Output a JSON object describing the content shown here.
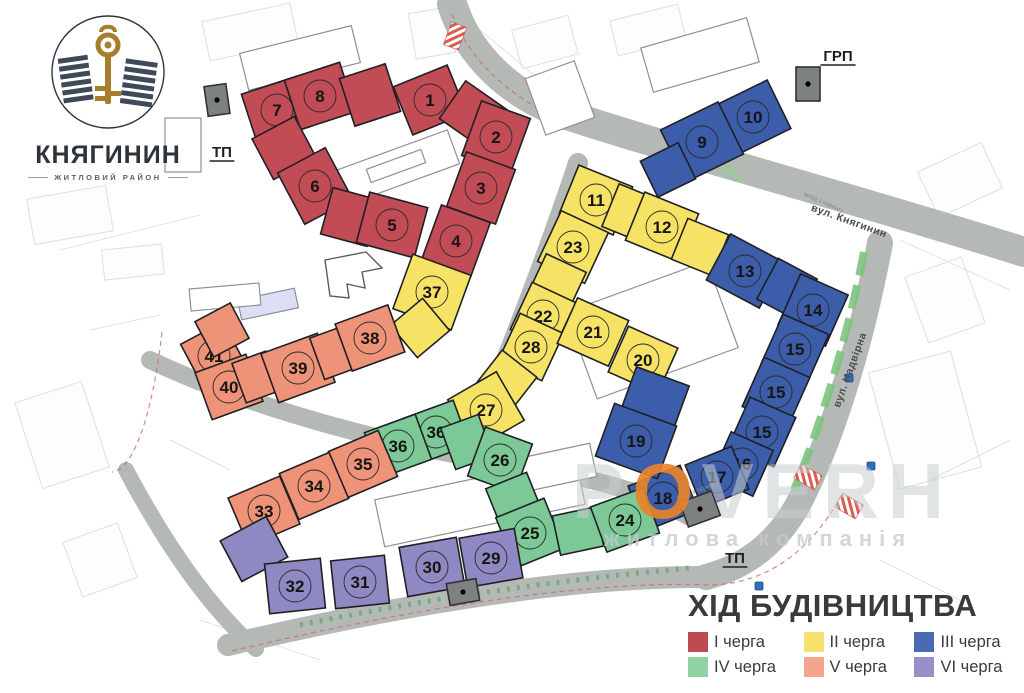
{
  "logo": {
    "name": "КНЯГИНИН",
    "subtitle": "ЖИТЛОВИЙ РАЙОН"
  },
  "watermark": {
    "text": "POVERH",
    "accent_index": 1,
    "subtext": "житлова компанія"
  },
  "footer": {
    "title": "ХІД БУДІВНИЦТВА"
  },
  "legend": {
    "items": [
      {
        "label": "I черга",
        "color": "#BE4A54"
      },
      {
        "label": "II черга",
        "color": "#F6E26B"
      },
      {
        "label": "III черга",
        "color": "#4A6BB2"
      },
      {
        "label": "IV черга",
        "color": "#90D2A3"
      },
      {
        "label": "V черга",
        "color": "#F4A58D"
      },
      {
        "label": "VI черга",
        "color": "#9790C8"
      }
    ]
  },
  "map": {
    "phase_colors": {
      "1": "#C14C55",
      "2": "#F6E366",
      "3": "#3C5DA9",
      "4": "#7CC897",
      "5": "#EE9377",
      "6": "#8F89C3"
    },
    "units": [
      {
        "n": "7",
        "phase": 1,
        "x": 277,
        "y": 110,
        "r": -18
      },
      {
        "n": "8",
        "phase": 1,
        "x": 320,
        "y": 96,
        "r": -18
      },
      {
        "n": "",
        "phase": 1,
        "x": 370,
        "y": 95,
        "r": -18,
        "w": 48,
        "h": 50
      },
      {
        "n": "1",
        "phase": 1,
        "x": 430,
        "y": 100,
        "r": -22
      },
      {
        "n": "",
        "phase": 1,
        "x": 473,
        "y": 114,
        "r": -55,
        "w": 46,
        "h": 50
      },
      {
        "n": "2",
        "phase": 1,
        "x": 496,
        "y": 137,
        "r": -70
      },
      {
        "n": "3",
        "phase": 1,
        "x": 481,
        "y": 188,
        "r": -70
      },
      {
        "n": "4",
        "phase": 1,
        "x": 456,
        "y": 241,
        "r": -70
      },
      {
        "n": "",
        "phase": 1,
        "x": 284,
        "y": 148,
        "r": 62,
        "w": 46,
        "h": 48
      },
      {
        "n": "6",
        "phase": 1,
        "x": 315,
        "y": 186,
        "r": 62,
        "w": 58,
        "h": 54
      },
      {
        "n": "",
        "phase": 1,
        "x": 350,
        "y": 217,
        "r": 15,
        "w": 48,
        "h": 48
      },
      {
        "n": "5",
        "phase": 1,
        "x": 392,
        "y": 225,
        "r": 15,
        "w": 60,
        "h": 52
      },
      {
        "n": "37",
        "phase": 2,
        "x": 432,
        "y": 292,
        "r": -70,
        "w": 58,
        "h": 62
      },
      {
        "n": "",
        "phase": 2,
        "x": 420,
        "y": 328,
        "r": -40,
        "w": 42,
        "h": 42
      },
      {
        "n": "11",
        "phase": 2,
        "x": 596,
        "y": 200,
        "r": 22
      },
      {
        "n": "",
        "phase": 2,
        "x": 630,
        "y": 213,
        "r": 22,
        "w": 42,
        "h": 46
      },
      {
        "n": "12",
        "phase": 2,
        "x": 662,
        "y": 227,
        "r": 22
      },
      {
        "n": "",
        "phase": 2,
        "x": 700,
        "y": 247,
        "r": 22,
        "w": 44,
        "h": 44
      },
      {
        "n": "23",
        "phase": 2,
        "x": 573,
        "y": 247,
        "r": -65,
        "w": 56,
        "h": 52
      },
      {
        "n": "",
        "phase": 2,
        "x": 557,
        "y": 283,
        "r": -65,
        "w": 44,
        "h": 44
      },
      {
        "n": "22",
        "phase": 2,
        "x": 543,
        "y": 316,
        "r": -65,
        "w": 52,
        "h": 48
      },
      {
        "n": "28",
        "phase": 2,
        "x": 531,
        "y": 347,
        "r": -65,
        "w": 52,
        "h": 48
      },
      {
        "n": "21",
        "phase": 2,
        "x": 593,
        "y": 332,
        "r": 24,
        "w": 56,
        "h": 50
      },
      {
        "n": "20",
        "phase": 2,
        "x": 643,
        "y": 360,
        "r": 24,
        "w": 54,
        "h": 50
      },
      {
        "n": "",
        "phase": 2,
        "x": 506,
        "y": 381,
        "r": -52,
        "w": 44,
        "h": 44
      },
      {
        "n": "27",
        "phase": 2,
        "x": 486,
        "y": 410,
        "r": -30,
        "w": 56,
        "h": 56
      },
      {
        "n": "10",
        "phase": 3,
        "x": 753,
        "y": 117,
        "r": -26,
        "w": 58,
        "h": 54
      },
      {
        "n": "9",
        "phase": 3,
        "x": 702,
        "y": 142,
        "r": -26,
        "w": 64,
        "h": 58
      },
      {
        "n": "",
        "phase": 3,
        "x": 668,
        "y": 170,
        "r": -26,
        "w": 42,
        "h": 40
      },
      {
        "n": "13",
        "phase": 3,
        "x": 745,
        "y": 271,
        "r": 28,
        "w": 60,
        "h": 52
      },
      {
        "n": "",
        "phase": 3,
        "x": 787,
        "y": 289,
        "r": 28,
        "w": 44,
        "h": 46
      },
      {
        "n": "14",
        "phase": 3,
        "x": 813,
        "y": 310,
        "r": -66,
        "w": 56,
        "h": 52
      },
      {
        "n": "15",
        "phase": 3,
        "x": 795,
        "y": 349,
        "r": -66,
        "w": 54,
        "h": 50
      },
      {
        "n": "15",
        "phase": 3,
        "x": 776,
        "y": 392,
        "r": -66,
        "w": 54,
        "h": 50
      },
      {
        "n": "15",
        "phase": 3,
        "x": 762,
        "y": 432,
        "r": -66,
        "w": 54,
        "h": 50
      },
      {
        "n": "16",
        "phase": 3,
        "x": 742,
        "y": 464,
        "r": -66,
        "w": 50,
        "h": 46
      },
      {
        "n": "17",
        "phase": 3,
        "x": 717,
        "y": 477,
        "r": -22,
        "w": 50,
        "h": 46
      },
      {
        "n": "18",
        "phase": 3,
        "x": 663,
        "y": 498,
        "r": -22,
        "w": 56,
        "h": 48
      },
      {
        "n": "",
        "phase": 3,
        "x": 655,
        "y": 398,
        "r": -70,
        "w": 46,
        "h": 56
      },
      {
        "n": "19",
        "phase": 3,
        "x": 636,
        "y": 441,
        "r": -70,
        "w": 56,
        "h": 66
      },
      {
        "n": "36",
        "phase": 4,
        "x": 436,
        "y": 432,
        "r": -20,
        "w": 54,
        "h": 48
      },
      {
        "n": "36",
        "phase": 4,
        "x": 398,
        "y": 446,
        "r": -20,
        "w": 54,
        "h": 48
      },
      {
        "n": "",
        "phase": 4,
        "x": 467,
        "y": 442,
        "r": -20,
        "w": 40,
        "h": 44
      },
      {
        "n": "26",
        "phase": 4,
        "x": 500,
        "y": 460,
        "r": -70,
        "w": 52,
        "h": 50
      },
      {
        "n": "",
        "phase": 4,
        "x": 514,
        "y": 500,
        "r": 68,
        "w": 42,
        "h": 44
      },
      {
        "n": "25",
        "phase": 4,
        "x": 530,
        "y": 533,
        "r": 68,
        "w": 54,
        "h": 52
      },
      {
        "n": "",
        "phase": 4,
        "x": 578,
        "y": 531,
        "r": -12,
        "w": 44,
        "h": 40
      },
      {
        "n": "24",
        "phase": 4,
        "x": 625,
        "y": 520,
        "r": -20,
        "w": 56,
        "h": 48
      },
      {
        "n": "41",
        "phase": 5,
        "x": 214,
        "y": 356,
        "r": 62,
        "w": 52,
        "h": 48
      },
      {
        "n": "",
        "phase": 5,
        "x": 222,
        "y": 330,
        "r": 62,
        "w": 40,
        "h": 40
      },
      {
        "n": "40",
        "phase": 5,
        "x": 229,
        "y": 387,
        "r": -20,
        "w": 54,
        "h": 50
      },
      {
        "n": "",
        "phase": 5,
        "x": 256,
        "y": 377,
        "r": -20,
        "w": 36,
        "h": 42
      },
      {
        "n": "39",
        "phase": 5,
        "x": 298,
        "y": 368,
        "r": -20,
        "w": 60,
        "h": 52
      },
      {
        "n": "",
        "phase": 5,
        "x": 336,
        "y": 352,
        "r": -20,
        "w": 40,
        "h": 44
      },
      {
        "n": "38",
        "phase": 5,
        "x": 370,
        "y": 338,
        "r": -20,
        "w": 56,
        "h": 50
      },
      {
        "n": "35",
        "phase": 5,
        "x": 363,
        "y": 464,
        "r": -23,
        "w": 54,
        "h": 50
      },
      {
        "n": "34",
        "phase": 5,
        "x": 314,
        "y": 486,
        "r": -23,
        "w": 54,
        "h": 50
      },
      {
        "n": "33",
        "phase": 5,
        "x": 264,
        "y": 511,
        "r": -23,
        "w": 56,
        "h": 52
      },
      {
        "n": "",
        "phase": 6,
        "x": 254,
        "y": 549,
        "r": 62,
        "w": 46,
        "h": 52
      },
      {
        "n": "32",
        "phase": 6,
        "x": 295,
        "y": 586,
        "r": -6,
        "w": 56,
        "h": 50
      },
      {
        "n": "31",
        "phase": 6,
        "x": 360,
        "y": 582,
        "r": -6,
        "w": 54,
        "h": 48
      },
      {
        "n": "30",
        "phase": 6,
        "x": 432,
        "y": 567,
        "r": -10,
        "w": 58,
        "h": 50
      },
      {
        "n": "29",
        "phase": 6,
        "x": 491,
        "y": 558,
        "r": -10,
        "w": 56,
        "h": 50
      }
    ],
    "station_labels": [
      {
        "text": "ТП",
        "x": 222,
        "y": 157
      },
      {
        "text": "ГРП",
        "x": 838,
        "y": 61
      },
      {
        "text": "ТП",
        "x": 735,
        "y": 563
      }
    ],
    "street_labels": [
      {
        "text": "вул. Княгинин",
        "x": 848,
        "y": 224,
        "rot": 20
      },
      {
        "text": "вул. Надвірна",
        "x": 853,
        "y": 371,
        "rot": -70
      }
    ],
    "small_labels": [
      {
        "text": "виїзд з паркінгу",
        "x": 698,
        "y": 492,
        "rot": -20
      },
      {
        "text": "виїзд з паркінгу",
        "x": 823,
        "y": 204,
        "rot": 24
      }
    ]
  }
}
